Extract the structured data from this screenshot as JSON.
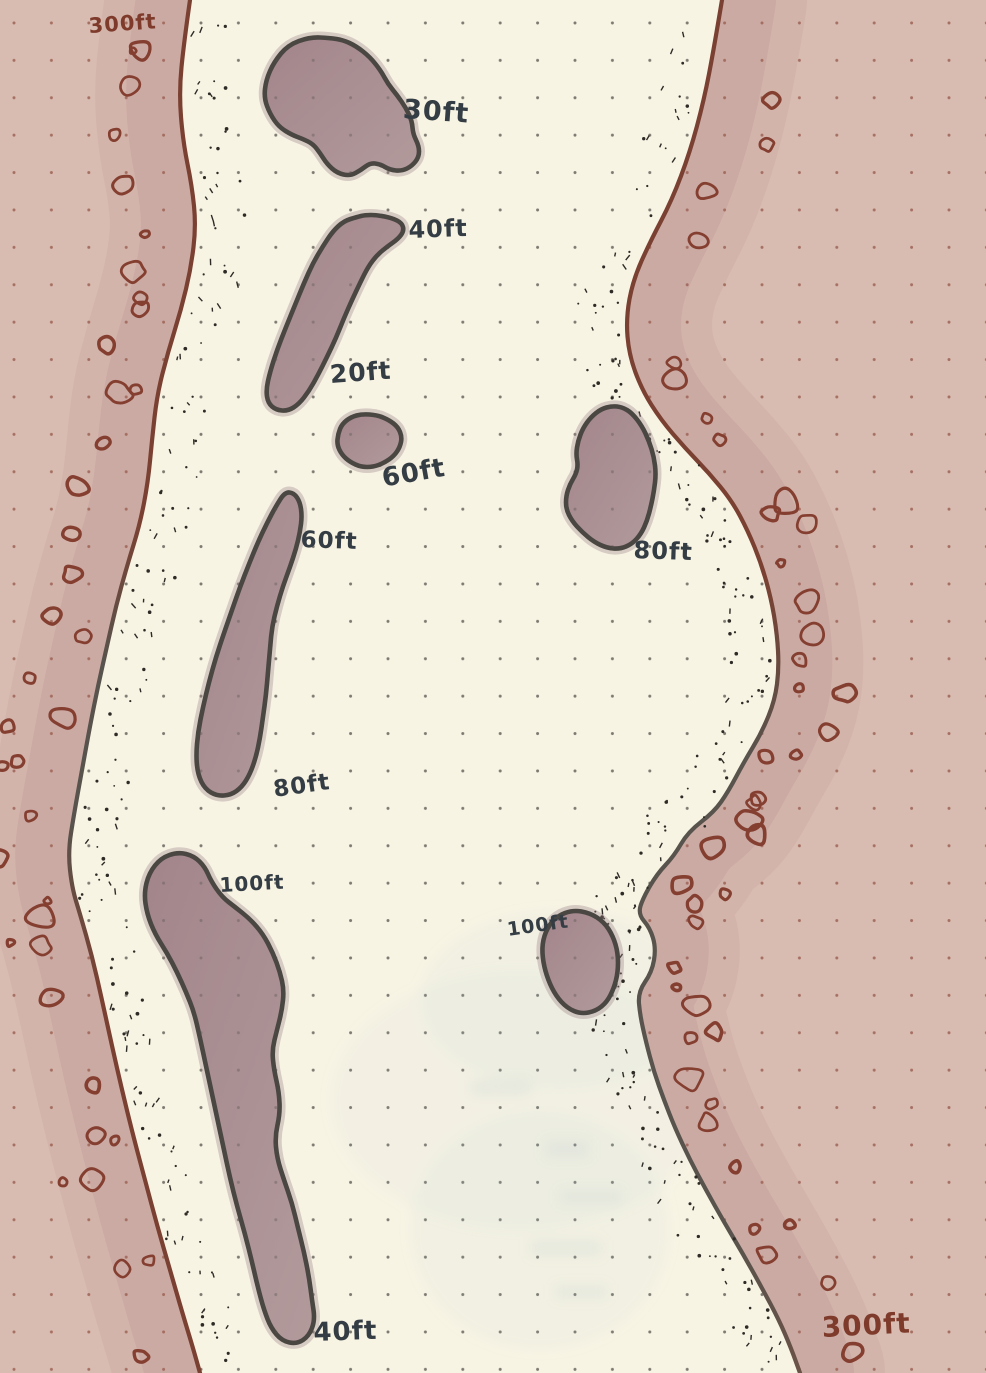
{
  "map": {
    "description": "hand-drawn channel depth map on dot-grid paper",
    "colors": {
      "water": "#f8f4e4",
      "land": "#d9bcb1",
      "wet_band": "#c49e9b",
      "island_fill": "#a98d90",
      "island_outline": "#4a4642",
      "rock_outline": "#843f30",
      "shoreline_brown": "#7a4132",
      "shoreline_gray": "#58534c",
      "grid_dot_on_water": "#54514a",
      "grid_dot_on_land": "#9c6355",
      "stipple_ink": "#2e2b26",
      "label_ink": "#353d44",
      "label_maroon": "#7e3b2b"
    },
    "labels": [
      {
        "id": "300ft-north-shore",
        "text": "300ft",
        "x": 88,
        "y": 16,
        "size": 21,
        "rotate": -4,
        "ink": "maroon"
      },
      {
        "id": "30ft",
        "text": "30ft",
        "x": 404,
        "y": 96,
        "size": 27,
        "rotate": 4,
        "ink": "dark"
      },
      {
        "id": "40ft-upper",
        "text": "40ft",
        "x": 408,
        "y": 218,
        "size": 24,
        "rotate": -2,
        "ink": "dark"
      },
      {
        "id": "20ft",
        "text": "20ft",
        "x": 329,
        "y": 362,
        "size": 25,
        "rotate": -4,
        "ink": "dark"
      },
      {
        "id": "60ft-shoal",
        "text": "60ft",
        "x": 380,
        "y": 466,
        "size": 26,
        "rotate": -10,
        "ink": "dark"
      },
      {
        "id": "60ft-island",
        "text": "60ft",
        "x": 301,
        "y": 529,
        "size": 23,
        "rotate": 2,
        "ink": "dark"
      },
      {
        "id": "80ft-east",
        "text": "80ft",
        "x": 634,
        "y": 538,
        "size": 24,
        "rotate": 2,
        "ink": "dark"
      },
      {
        "id": "80ft-west",
        "text": "80ft",
        "x": 272,
        "y": 779,
        "size": 23,
        "rotate": -8,
        "ink": "dark"
      },
      {
        "id": "100ft-west",
        "text": "100ft",
        "x": 219,
        "y": 875,
        "size": 20,
        "rotate": -3,
        "ink": "dark"
      },
      {
        "id": "100ft-east",
        "text": "100ft",
        "x": 506,
        "y": 921,
        "size": 19,
        "rotate": -8,
        "ink": "dark"
      },
      {
        "id": "40ft-south",
        "text": "40ft",
        "x": 313,
        "y": 1320,
        "size": 26,
        "rotate": -2,
        "ink": "dark"
      },
      {
        "id": "300ft-south-shore",
        "text": "300ft",
        "x": 821,
        "y": 1314,
        "size": 28,
        "rotate": -3,
        "ink": "maroon"
      }
    ]
  }
}
